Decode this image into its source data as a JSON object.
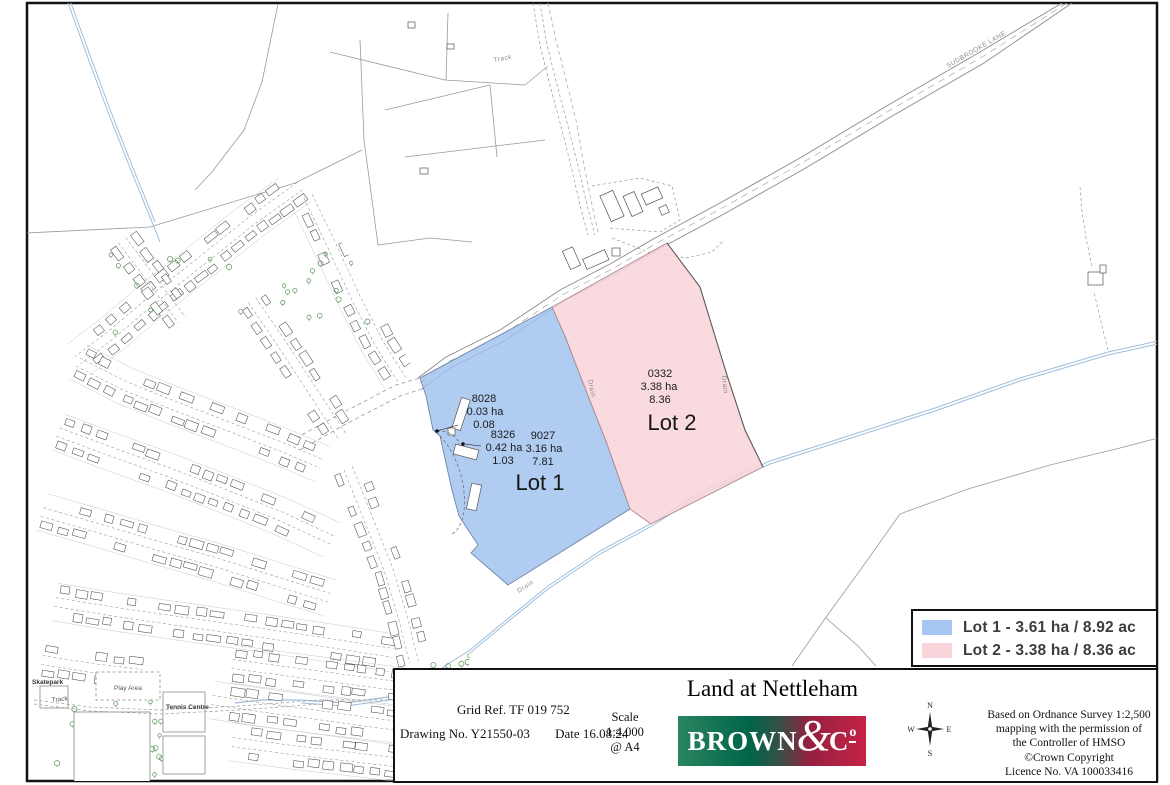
{
  "map": {
    "road_label": "SUDBROOKE LANE",
    "track_label": "Track",
    "drain_label": "Drain",
    "village": {
      "skatepark": "Skatepark",
      "play_area": "Play Area",
      "track": "Track",
      "tennis_centre": "Tennis Centre"
    },
    "lots": [
      {
        "name": "Lot 1",
        "color": "#9fc1ee",
        "parcels": [
          {
            "number": "8028",
            "ha": "0.03 ha",
            "ac": "0.08"
          },
          {
            "number": "8326",
            "ha": "0.42 ha",
            "ac": "1.03"
          },
          {
            "number": "9027",
            "ha": "3.16 ha",
            "ac": "7.81"
          }
        ]
      },
      {
        "name": "Lot 2",
        "color": "#f8d3d8",
        "parcels": [
          {
            "number": "0332",
            "ha": "3.38 ha",
            "ac": "8.36"
          }
        ]
      }
    ]
  },
  "legend": {
    "items": [
      {
        "color": "#a6c6f2",
        "label": "Lot 1 - 3.61 ha / 8.92 ac"
      },
      {
        "color": "#f9d4da",
        "label": "Lot 2 - 3.38 ha / 8.36 ac"
      }
    ]
  },
  "title_block": {
    "grid_ref": "Grid Ref. TF 019 752",
    "drawing_no": "Drawing No. Y21550-03",
    "date": "Date 16.08.24",
    "scale_label": "Scale",
    "scale_value": "1:4,000",
    "scale_sheet": "@ A4",
    "title": "Land at Nettleham",
    "logo": {
      "brown": "BROWN",
      "amp": "&",
      "c": "C",
      "o": "o"
    },
    "compass": {
      "n": "N",
      "e": "E",
      "s": "S",
      "w": "W"
    },
    "attribution": [
      "Based on Ordnance Survey 1:2,500",
      "mapping with the permission of",
      "the Controller of HMSO",
      "©Crown Copyright",
      "Licence No. VA 100033416"
    ]
  }
}
